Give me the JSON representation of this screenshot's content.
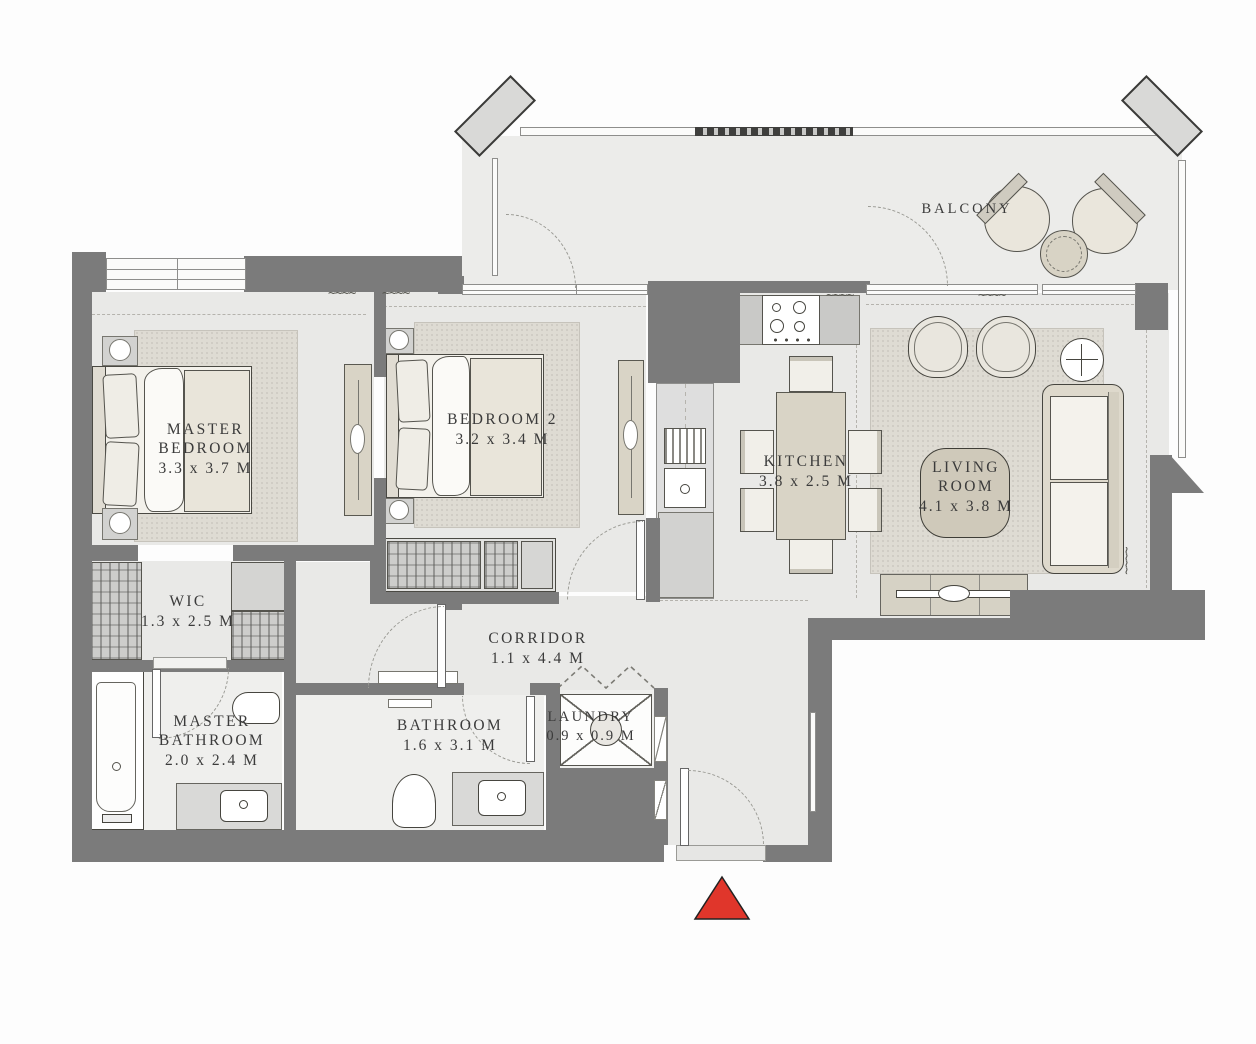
{
  "plan": {
    "rooms": {
      "master_bedroom": {
        "name": "MASTER\nBEDROOM",
        "dims": "3.3 x 3.7 M"
      },
      "bedroom_2": {
        "name": "BEDROOM 2",
        "dims": "3.2 x 3.4 M"
      },
      "wic": {
        "name": "WIC",
        "dims": "1.3 x 2.5 M"
      },
      "master_bathroom": {
        "name": "MASTER\nBATHROOM",
        "dims": "2.0 x 2.4 M"
      },
      "bathroom": {
        "name": "BATHROOM",
        "dims": "1.6 x 3.1 M"
      },
      "laundry": {
        "name": "LAUNDRY",
        "dims": "0.9 x 0.9 M"
      },
      "corridor": {
        "name": "CORRIDOR",
        "dims": "1.1 x 4.4 M"
      },
      "kitchen": {
        "name": "KITCHEN",
        "dims": "3.8 x 2.5 M"
      },
      "living_room": {
        "name": "LIVING\nROOM",
        "dims": "4.1 x 3.8 M"
      },
      "balcony": {
        "name": "BALCONY",
        "dims": ""
      }
    },
    "colors": {
      "wall": "#7b7b7b",
      "floor": "#e9e9e7",
      "rug": "#dedbd3",
      "furniture": "#d9d4c6",
      "entrance_marker": "#e0362b"
    },
    "decor": {
      "squiggle": "~~~~"
    }
  }
}
